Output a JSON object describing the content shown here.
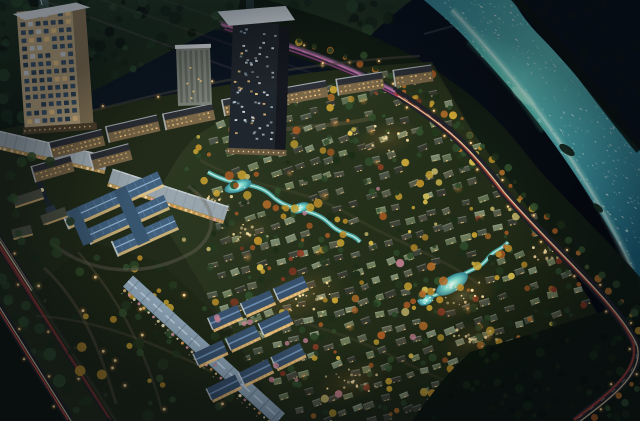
{
  "scene": {
    "label": "night-aerial-rendering-of-riverside-residential-masterplan",
    "time_of_day": "night",
    "camera": "aerial-oblique",
    "landmarks": [
      {
        "name": "beige-highrise-tower",
        "position": "top-left"
      },
      {
        "name": "checkered-highrise-tower",
        "position": "top-center"
      },
      {
        "name": "apartment-slab-row",
        "position": "upper-left-band"
      },
      {
        "name": "school-campus-with-clock-tower",
        "position": "center-left"
      },
      {
        "name": "retail-arcade-roofs",
        "position": "left-of-campus"
      },
      {
        "name": "commercial-strip",
        "position": "lower-left-diagonal"
      },
      {
        "name": "townhouse-rows",
        "position": "bottom-center-left"
      },
      {
        "name": "villa-field-with-autumn-trees",
        "position": "center-and-right"
      },
      {
        "name": "winding-streams-and-ponds",
        "position": "center"
      },
      {
        "name": "river",
        "position": "right-diagonal"
      },
      {
        "name": "riverside-road-with-light-trails",
        "position": "along-river"
      },
      {
        "name": "boulevards-with-light-trails",
        "position": "bottom-left"
      },
      {
        "name": "forest",
        "position": "bottom-right-corner"
      }
    ]
  },
  "palette": {
    "sky_top_left": "#101c26",
    "sky_mid": "#0a1420",
    "sky_corner": "#05090f",
    "hill_base_top": "#233824",
    "hill_base_bottom": "#121d12",
    "hill_blobs": [
      "#16261a",
      "#1e3322",
      "#26402a",
      "#101a12",
      "#2c4a2e"
    ],
    "river_deep": "#1d6a85",
    "river_mid": "#49aab2",
    "river_bright": "#5fc2bd",
    "river_core": "#aef0df",
    "river_core_hot": "#e8fff6",
    "river_shoal": "#bff2da",
    "river_green": "#58c49a",
    "sparkle": [
      "#ffffff",
      "#e6fff7",
      "#bdf2e6",
      "#8fe0d6",
      "#63c6c0",
      "#ffffff"
    ],
    "far_bank": "#0b140d",
    "far_area": "#0a1118",
    "asphalt": "#1f2127",
    "trail_red": "#d14a38",
    "trail_warm": "#f2dfae",
    "trail_pink": "#e27fc6",
    "trail_pink_dark": "#b3509b",
    "trail_pink_light": "#f4b6e2",
    "road_dash": "#ffffff",
    "lamp_core": "#ffe3a6",
    "lamp_halo": "#ff9d3d",
    "ground": "#222b19",
    "field_top": "#2d3a22",
    "field_bottom": "#1b2412",
    "park": "#1d2716",
    "path_pale": "#6b6048",
    "villa_roofs": [
      "#6c7b59",
      "#77866b",
      "#5f6e51",
      "#3e4337",
      "#474a3d",
      "#35392f",
      "#4a5345",
      "#555b48"
    ],
    "villa_ridge": "rgba(214,219,196,0.3)",
    "window_warm": "#ffd083",
    "tree_greens": [
      "#24381e",
      "#2c4728",
      "#1c2d18",
      "#314f2c"
    ],
    "tree_gold": [
      "#c9a232",
      "#bb8d2a"
    ],
    "tree_yellow": [
      "#e0c552",
      "#d6bb4a"
    ],
    "tree_orange": [
      "#b76f2a",
      "#a85a24"
    ],
    "tree_red": [
      "#8f3f26",
      "#7e3522"
    ],
    "tree_pale": [
      "#cdbd6e"
    ],
    "tree_pink": [
      "#c27f92"
    ],
    "forest_blobs": [
      "#0c150c",
      "#13200f",
      "#182a14",
      "#0a120a"
    ],
    "campus_roof": "#40607e",
    "campus_ridge": "#9cbcd8",
    "campus_rib": "#6f95b8",
    "campus_wall": "#e2c488",
    "spire": "#1f2830",
    "town_roof": "#37506b",
    "town_ridge": "#7294b6",
    "town_face": "#f0c27c",
    "gable": "#d5dde3",
    "strip_roof": "#8fa7ba",
    "strip_ridge": "#c6d8e6",
    "arcade_roof_a": "#a7b3bb",
    "arcade_roof_b": "#98a5ad",
    "arcade_face": "#caa05c",
    "apt_roof": "#2c2f35",
    "apt_roof_light": "#c2ccd3",
    "apt_face": "#7a6748",
    "apt_ridge": "#c3ccd2",
    "tower1_face": "#c7b187",
    "tower1_side": "#93805e",
    "tower1_cap": "#e7edf2",
    "tower1_win": [
      "#2b4d6a",
      "#203c55",
      "#d8e4ec",
      "#ffd48a"
    ],
    "tower2_face": "#20262d",
    "tower2_side": "#15191f",
    "tower2_cap": "#dde6ec",
    "tower2_spk": [
      "#d4dde3",
      "#8fa6b6",
      "#ffd48a"
    ],
    "tower3_face": "#7f847c",
    "tower3_stripe": "#5f655c",
    "tower3_top": "#d9dfe3",
    "small_roof": "#4a4f41",
    "beam": "#9fd6ff",
    "streak_pink": [
      "#d9a2c8",
      "#cf8fba",
      "#e6c2da"
    ],
    "bridge": "#9fb2c2",
    "pond_center": "#dcf8ee",
    "pond_mid": "#6fd0c6",
    "pond_edge": "#2e7f90",
    "stream": "#4db4b4",
    "stream_core": "#b9ece0",
    "storefront_lights": [
      "#ffcf86",
      "#ffab5e",
      "#f2e3b0",
      "#e89bb0",
      "#fff1c9"
    ]
  },
  "generation": {
    "seed": 11,
    "villa_rows": 27,
    "villa_row_spacing": 16.5,
    "villa_step": 15,
    "villa_angle": -17,
    "tree_count": 380,
    "stream_tree_count": 30,
    "sparkle_count": 340,
    "hill_blob_count": 150,
    "forest_blob_count": 90,
    "park_tree_count": 55,
    "park_lamp_count": 13,
    "median_tree_count": 26,
    "road_lamp_spacing": 24,
    "boulevard_lamp_spacing": 28,
    "glow_clusters": [
      [
        300,
        296,
        48,
        26,
        -20,
        0.2
      ],
      [
        386,
        138,
        34,
        18,
        -15,
        0.18
      ],
      [
        462,
        296,
        40,
        22,
        -25,
        0.22
      ],
      [
        352,
        382,
        40,
        20,
        -18,
        0.18
      ],
      [
        247,
        232,
        28,
        16,
        -20,
        0.15
      ],
      [
        472,
        340,
        34,
        18,
        -22,
        0.16
      ],
      [
        545,
        252,
        26,
        14,
        -25,
        0.12
      ],
      [
        215,
        200,
        22,
        12,
        -20,
        0.12
      ]
    ]
  }
}
